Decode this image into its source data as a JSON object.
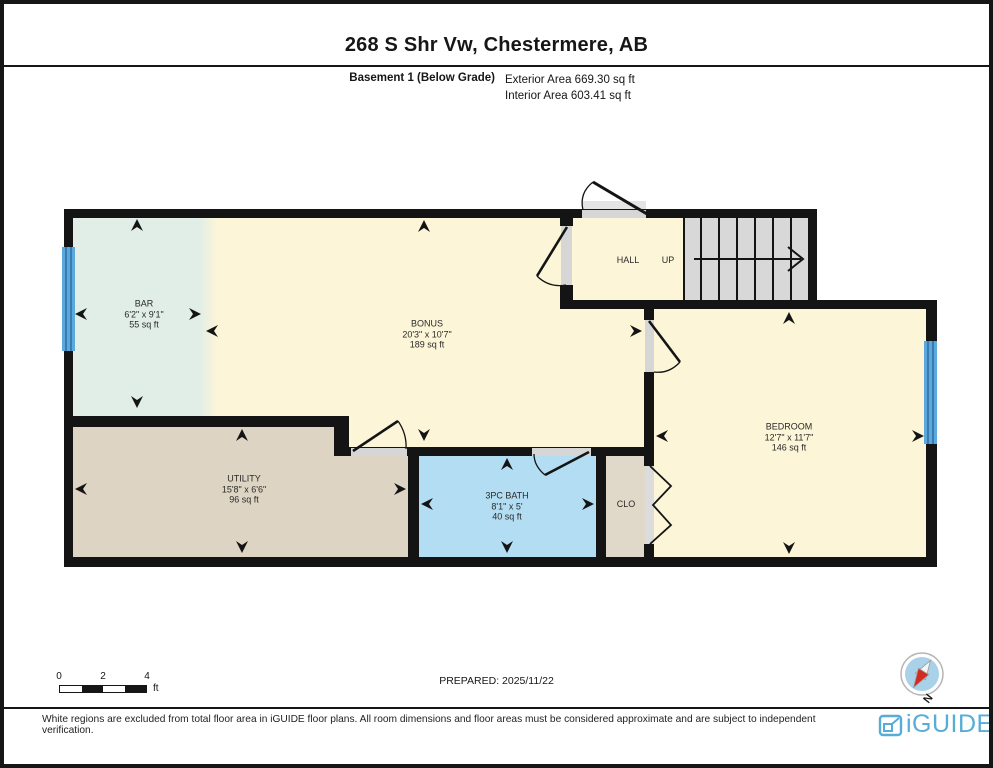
{
  "header": {
    "title": "268 S Shr Vw, Chestermere, AB",
    "floor_label": "Basement 1 (Below Grade)",
    "exterior_area": "Exterior Area 669.30 sq ft",
    "interior_area": "Interior Area 603.41 sq ft"
  },
  "rooms": {
    "bar": {
      "name": "BAR",
      "dims": "6'2\" x 9'1\"",
      "area": "55 sq ft"
    },
    "bonus": {
      "name": "BONUS",
      "dims": "20'3\" x 10'7\"",
      "area": "189 sq ft"
    },
    "hall": {
      "name": "HALL"
    },
    "up": {
      "label": "UP"
    },
    "bedroom": {
      "name": "BEDROOM",
      "dims": "12'7\" x 11'7\"",
      "area": "146 sq ft"
    },
    "utility": {
      "name": "UTILITY",
      "dims": "15'8\" x 6'6\"",
      "area": "96 sq ft"
    },
    "bath": {
      "name": "3PC BATH",
      "dims": "8'1\" x 5'",
      "area": "40 sq ft"
    },
    "closet": {
      "name": "CLO"
    }
  },
  "scale_bar": {
    "t0": "0",
    "t1": "2",
    "t2": "4",
    "unit": "ft"
  },
  "footer": {
    "prepared": "PREPARED: 2025/11/22",
    "disclaimer": "White regions are excluded from total floor area in iGUIDE floor plans. All room dimensions and floor areas must be considered approximate and are subject to independent verification."
  },
  "brand": {
    "name": "iGUIDE"
  },
  "compass": {
    "label": "N"
  },
  "colors": {
    "floor_yellow": "#fcf5d8",
    "bar_teal": "#e1ede7",
    "utility_tan": "#ddd4c3",
    "bath_blue": "#b3ddf2",
    "stairs_gray": "#d8d8d8",
    "window_blue": "#5ba8dd",
    "wall_black": "#141414",
    "brand_blue": "#57add7"
  }
}
